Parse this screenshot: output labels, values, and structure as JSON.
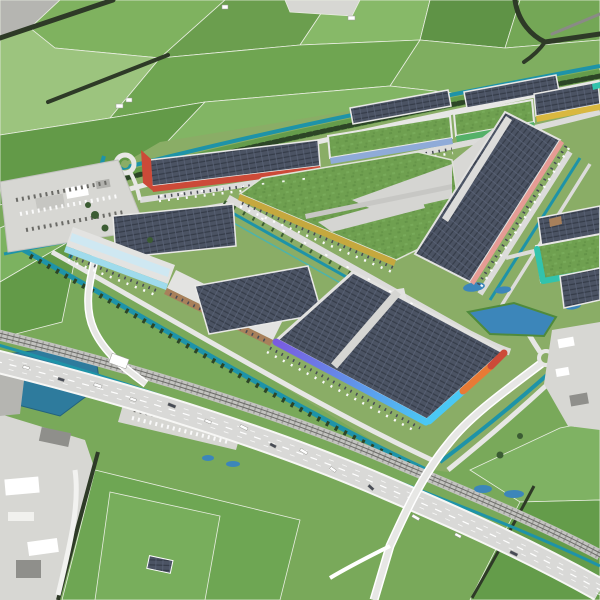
{
  "meta": {
    "scene": "aerial-3d-visualization-logistics-business-park",
    "view": "oblique-aerial-render",
    "style": "color-render-on-partially-desaturated-photo"
  },
  "palette": {
    "base_green": "#79a95a",
    "park_green": "#8aad66",
    "berm_green": "#659c4b",
    "grass_roof": "#6fa050",
    "grass_roof_dark": "#5d8c42",
    "grass_roof_light": "#7fb360",
    "solar_roof": "#4b5363",
    "solar_line": "#353c49",
    "solar_cell": "#5d6679",
    "roof_white": "#e3e3e1",
    "roof_gray": "#d5d5d2",
    "hardstand": "#d8d8d5",
    "road": "#e7e7e5",
    "road_minor": "#dcdcda",
    "road_dark": "#8a8a86",
    "canal": "#1e93a8",
    "canal_light": "#35b5c8",
    "lake": "#2e7b9d",
    "pond": "#3c86ba",
    "tree_dark": "#2c4526",
    "tree_mid": "#3b5c33",
    "hedge": "#2e3a27",
    "grayscale_light": "#d7d7d3",
    "grayscale_mid": "#b5b5b1",
    "grayscale_dark": "#8f8f8b",
    "rail_bed": "#c3c3c0",
    "rail_line": "#6b6b67",
    "highway": "#d9d9d7",
    "lane_white": "#ffffff",
    "vehicle_dark": "#474b55",
    "vehicle_white": "#fafafa"
  },
  "accents": {
    "red": "#cc4a38",
    "salmon": "#e59b94",
    "orange": "#e87a35",
    "yellow": "#d9b840",
    "mustard": "#c5a83e",
    "blue": "#8fabd8",
    "light_blue": "#9fdbec",
    "cyan": "#4ac8f4",
    "teal": "#32c3ac",
    "green": "#55b169",
    "brown": "#a8805b",
    "purple": "#7a5be0"
  },
  "buildings": [
    {
      "id": "warehouse-red",
      "roof": "solar",
      "accent": "red"
    },
    {
      "id": "warehouse-blue",
      "roof": "sedum",
      "accent": "blue"
    },
    {
      "id": "warehouse-green",
      "roof": "sedum",
      "accent": "green"
    },
    {
      "id": "warehouse-yellow",
      "roof": "solar",
      "accent": "yellow-with-teal-tip"
    },
    {
      "id": "warehouse-salmon-giant",
      "roof": "solar",
      "accent": "salmon"
    },
    {
      "id": "central-sedum-hall",
      "roof": "sedum",
      "accent": "mustard"
    },
    {
      "id": "warehouse-cyan",
      "roof": "white",
      "accent": "light_blue"
    },
    {
      "id": "warehouse-brown",
      "roof": "white",
      "accent": "brown"
    },
    {
      "id": "xl-distribution-center",
      "roof": "solar",
      "accent": "purple-to-cyan-gradient-plus-orange-red"
    },
    {
      "id": "warehouse-teal",
      "roof": "sedum",
      "accent": "teal"
    },
    {
      "id": "solar-roof-blocks",
      "roof": "solar",
      "accent": "none",
      "count": 6
    }
  ],
  "environment": {
    "farmland": "green-fields-with-hedgerows",
    "canals": "teal-drainage-canals-ringing-the-park",
    "lake": "water-basin-west",
    "ponds": "retention-ponds",
    "railway": "rail-corridor",
    "highway": "motorway-with-traffic-and-overpass",
    "truck_parking": "grayscale-truck-stop",
    "rest_area": "highway-rest-area",
    "roundabout": "entrance-roundabout",
    "surroundings": "existing-areas-desaturated-grayscale"
  }
}
